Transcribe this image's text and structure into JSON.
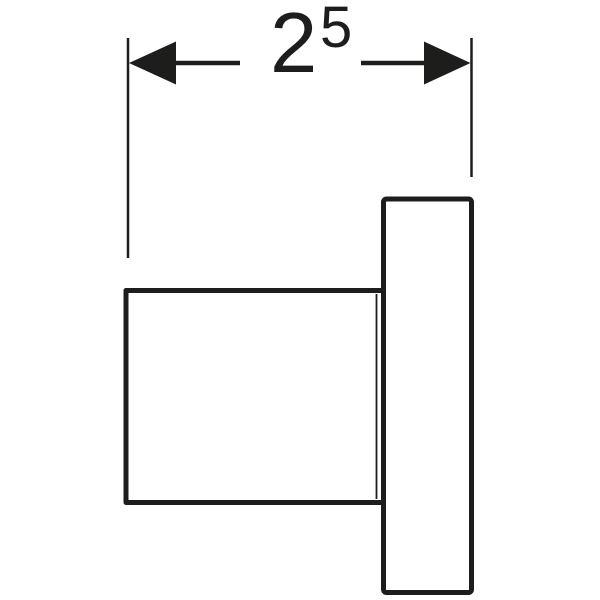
{
  "drawing": {
    "type": "technical-dimension-drawing",
    "colors": {
      "line": "#1d1d1b",
      "background": "#ffffff",
      "shape_fill": "#ffffff"
    },
    "dimension": {
      "value_main": "2",
      "value_superscript": "5"
    },
    "icons": {
      "arrow_left": "filled-triangle-pointing-left",
      "arrow_right": "filled-triangle-pointing-right"
    },
    "shapes": {
      "body": "rectangular-body-side-view",
      "flange": "tall-flange-plate-side-view"
    }
  }
}
